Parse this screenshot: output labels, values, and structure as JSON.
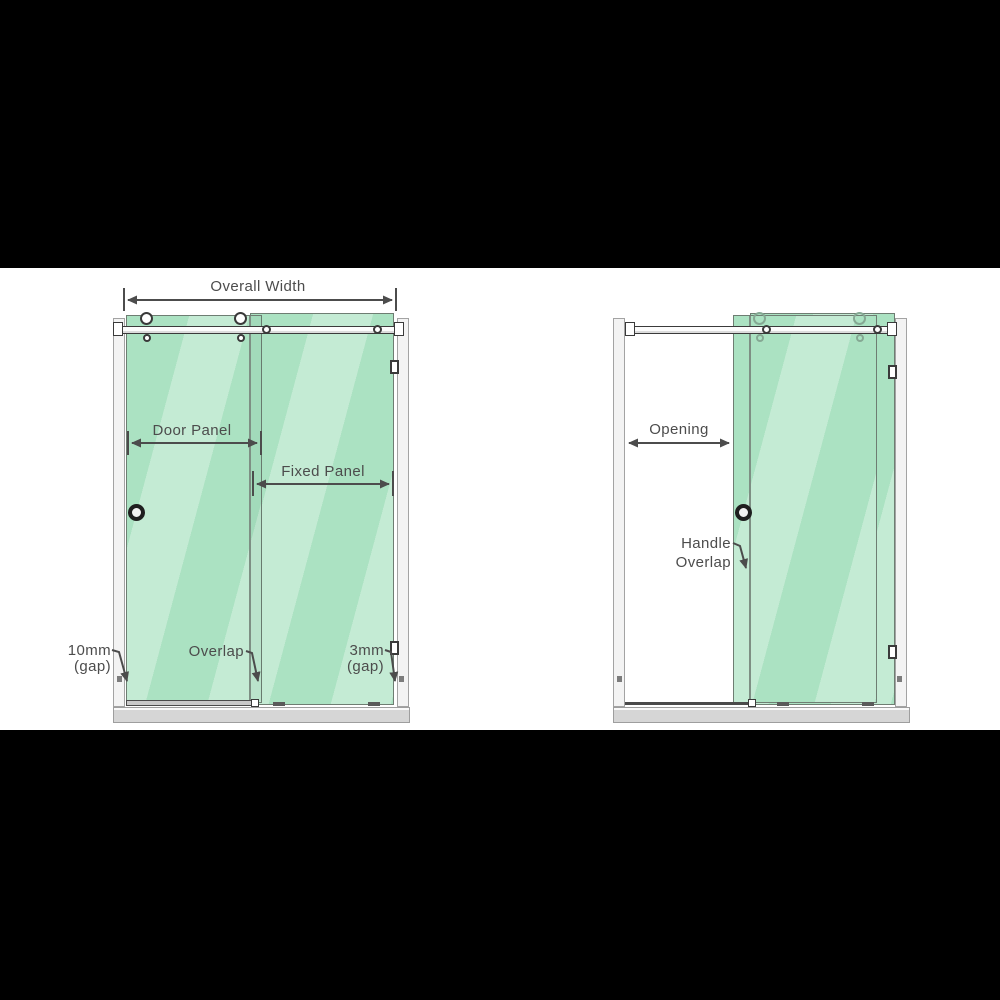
{
  "colors": {
    "backdrop": "#000000",
    "canvas": "#ffffff",
    "glass": "#abe2c2",
    "glass_edge": "#6e7d72",
    "wall": "#f3f3f3",
    "wall_border": "#a3a3a3",
    "tray": "#d6d6d6",
    "tray_border": "#9e9e9e",
    "hardware_outline": "#3a3a3a",
    "label_text": "#4c4c4c",
    "dimension_line": "#4c4c4c"
  },
  "left_diagram": {
    "labels": {
      "overall_width": "Overall Width",
      "door_panel": "Door Panel",
      "fixed_panel": "Fixed Panel",
      "gap_left_value": "10mm",
      "gap_left_unit": "(gap)",
      "overlap": "Overlap",
      "gap_right_value": "3mm",
      "gap_right_unit": "(gap)"
    }
  },
  "right_diagram": {
    "labels": {
      "opening": "Opening",
      "handle_overlap_line1": "Handle",
      "handle_overlap_line2": "Overlap"
    }
  }
}
